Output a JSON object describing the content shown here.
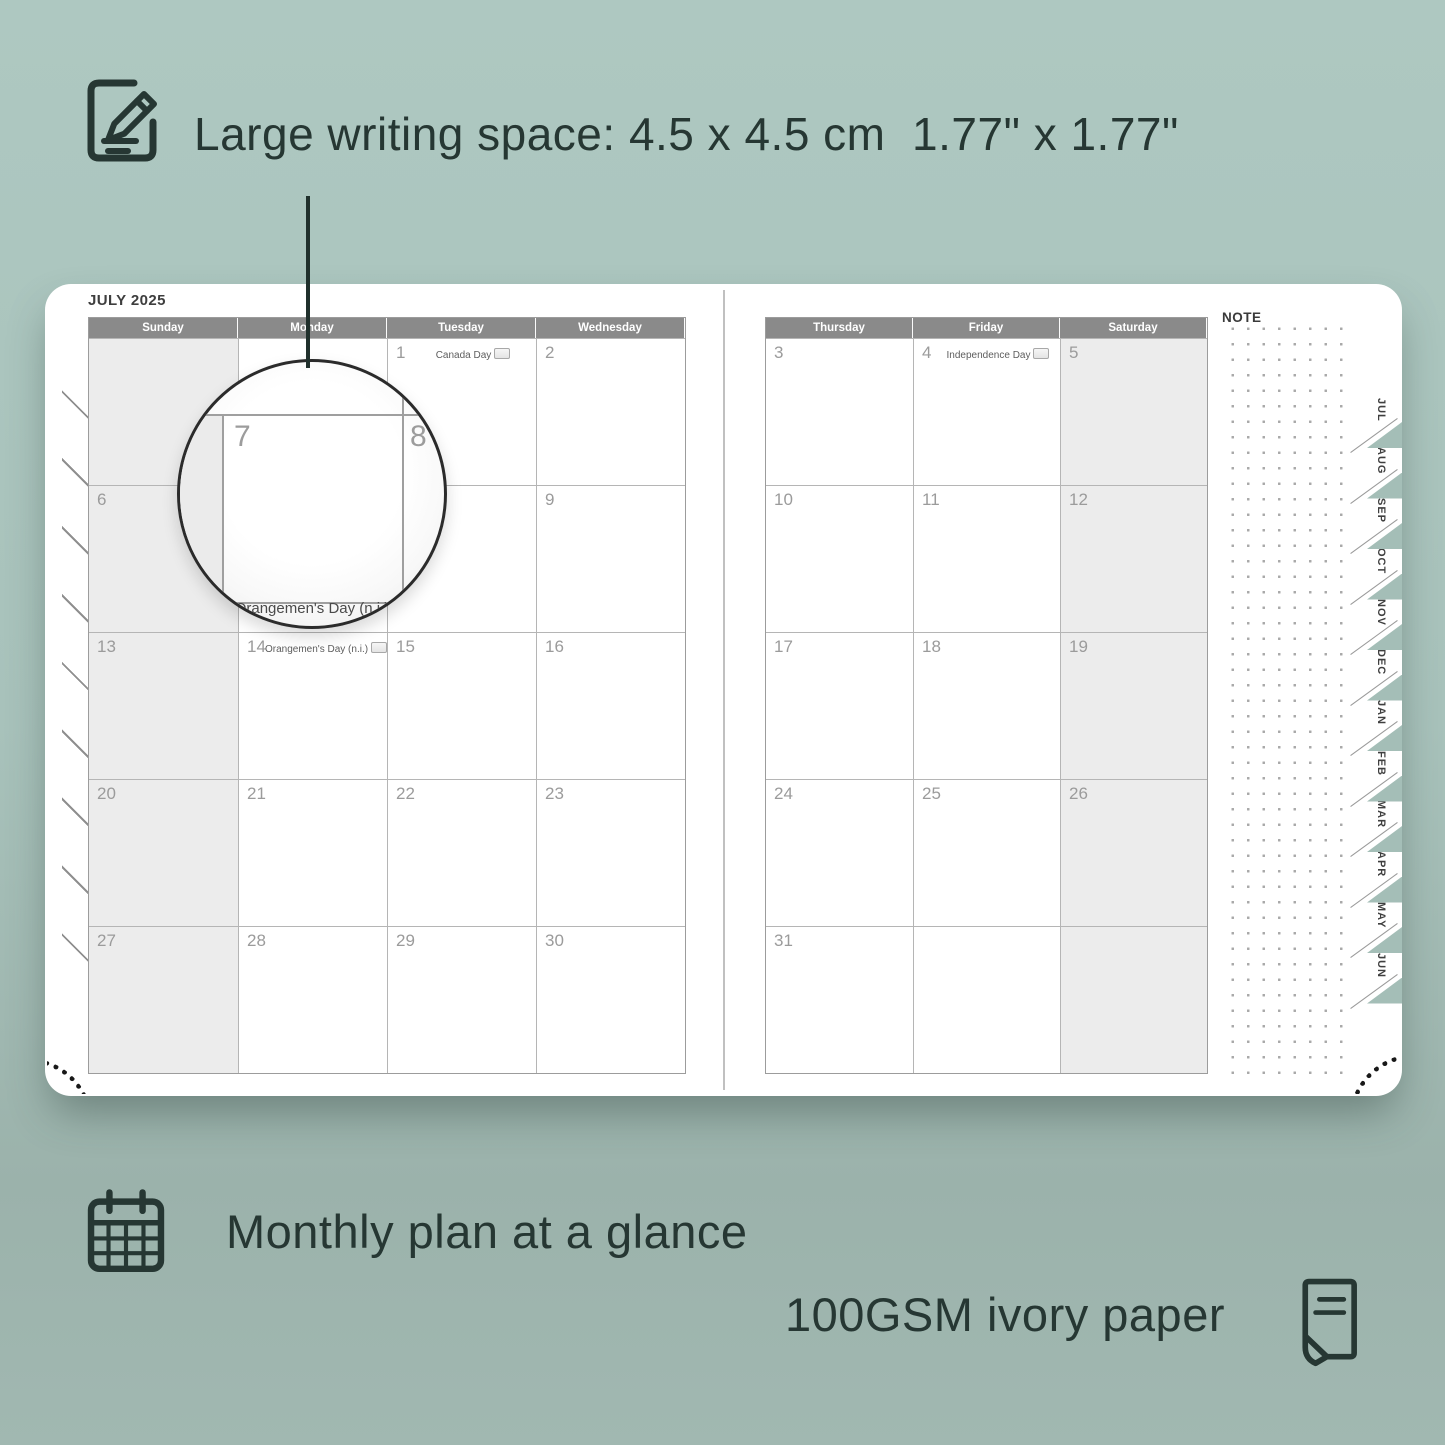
{
  "colors": {
    "background": "#a8c2bb",
    "accent_dark": "#263733",
    "header_gray": "#8a8a8a",
    "shaded_cell": "#ececec",
    "grid_line": "#b5b5b5"
  },
  "feature_writing_space": {
    "icon": "pencil-note-icon",
    "label": "Large writing space: 4.5 x 4.5 cm  1.77\" x 1.77\""
  },
  "planner": {
    "month_title": "JULY 2025",
    "note_label": "NOTE",
    "left_page": {
      "day_headers": [
        "Sunday",
        "Monday",
        "Tuesday",
        "Wednesday"
      ],
      "shaded_column": 0,
      "weeks": [
        [
          {
            "day": ""
          },
          {
            "day": ""
          },
          {
            "day": "1",
            "holiday": "Canada Day",
            "flag": true
          },
          {
            "day": "2"
          }
        ],
        [
          {
            "day": "6"
          },
          {
            "day": "7"
          },
          {
            "day": "8"
          },
          {
            "day": "9"
          }
        ],
        [
          {
            "day": "13"
          },
          {
            "day": "14",
            "holiday": "Orangemen's Day (n.i.)",
            "flag": true
          },
          {
            "day": "15"
          },
          {
            "day": "16"
          }
        ],
        [
          {
            "day": "20"
          },
          {
            "day": "21"
          },
          {
            "day": "22"
          },
          {
            "day": "23"
          }
        ],
        [
          {
            "day": "27"
          },
          {
            "day": "28"
          },
          {
            "day": "29"
          },
          {
            "day": "30"
          }
        ]
      ]
    },
    "right_page": {
      "day_headers": [
        "Thursday",
        "Friday",
        "Saturday"
      ],
      "shaded_column": 2,
      "weeks": [
        [
          {
            "day": "3"
          },
          {
            "day": "4",
            "holiday": "Independence Day",
            "flag": true
          },
          {
            "day": "5"
          }
        ],
        [
          {
            "day": "10"
          },
          {
            "day": "11"
          },
          {
            "day": "12"
          }
        ],
        [
          {
            "day": "17"
          },
          {
            "day": "18"
          },
          {
            "day": "19"
          }
        ],
        [
          {
            "day": "24"
          },
          {
            "day": "25"
          },
          {
            "day": "26"
          }
        ],
        [
          {
            "day": "31"
          },
          {
            "day": ""
          },
          {
            "day": ""
          }
        ]
      ]
    },
    "month_tabs": [
      "JUL",
      "AUG",
      "SEP",
      "OCT",
      "NOV",
      "DEC",
      "JAN",
      "FEB",
      "MAR",
      "APR",
      "MAY",
      "JUN"
    ],
    "magnifier": {
      "day_left": "7",
      "day_right": "8",
      "holiday_text": "Orangemen's Day (n.i.)"
    }
  },
  "feature_monthly": {
    "icon": "calendar-icon",
    "label": "Monthly plan at a glance"
  },
  "feature_paper": {
    "icon": "paper-icon",
    "label": "100GSM ivory paper"
  }
}
